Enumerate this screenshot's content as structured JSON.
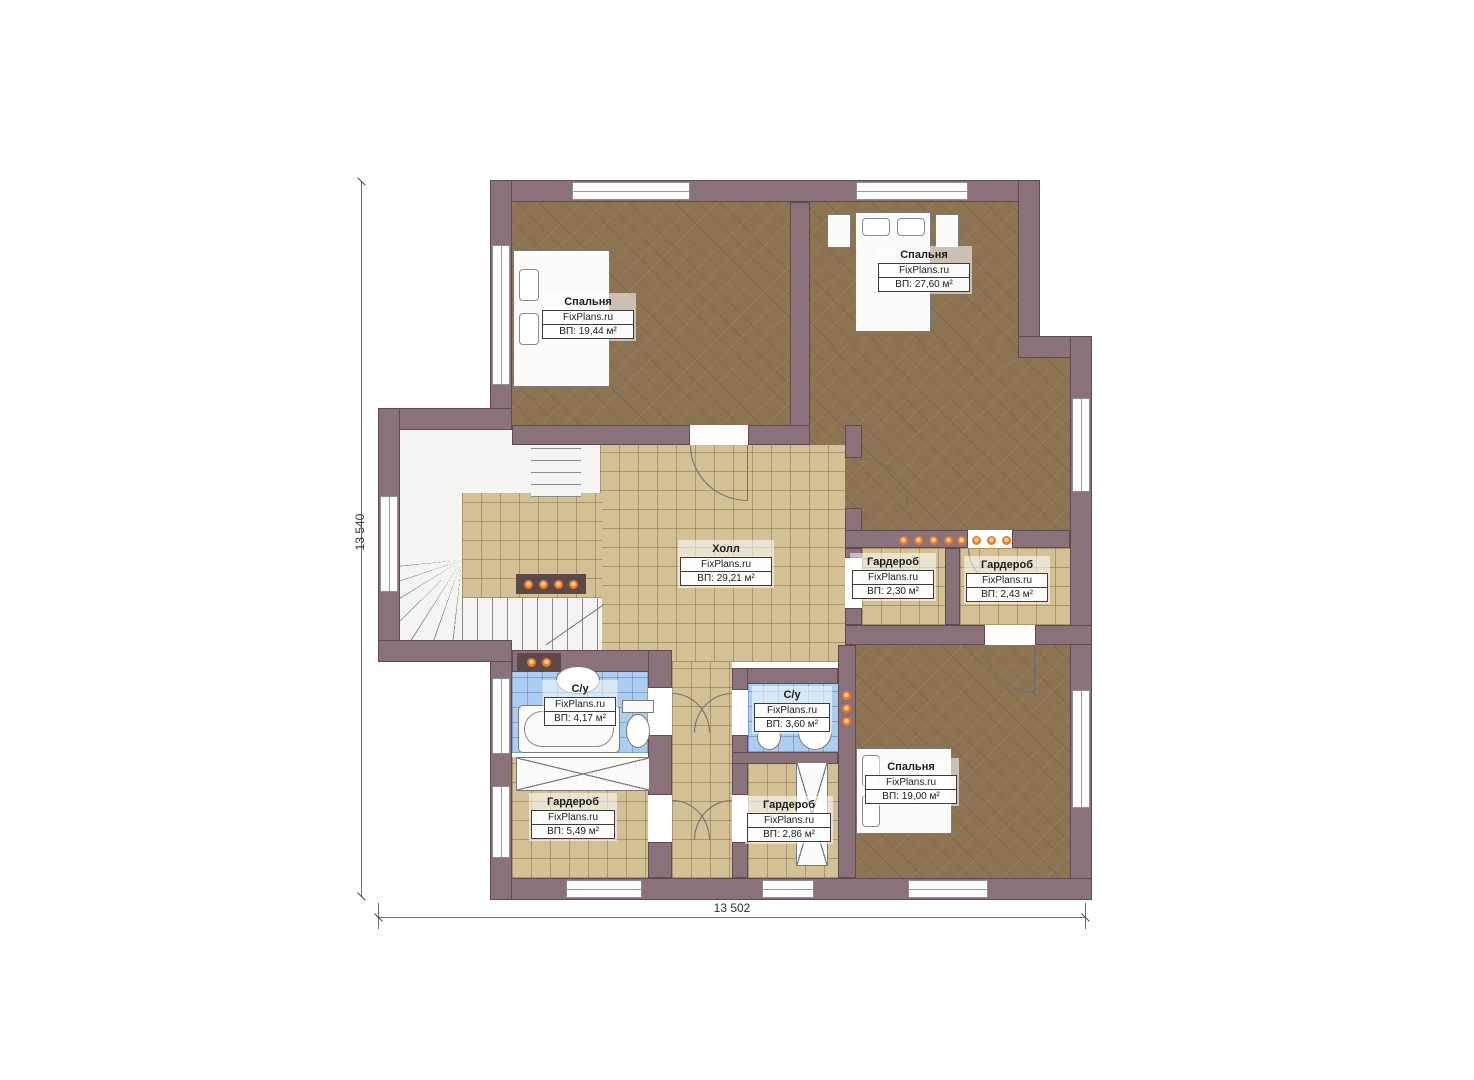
{
  "plan": {
    "type": "floor-plan",
    "watermark": "FixPlans.ru",
    "dimensions": {
      "left": "13 540",
      "bottom": "13 502"
    },
    "rooms": [
      {
        "name": "Спальня",
        "site": "FixPlans.ru",
        "area": "ВП: 19,44 м²"
      },
      {
        "name": "Спальня",
        "site": "FixPlans.ru",
        "area": "ВП: 27,60 м²"
      },
      {
        "name": "Холл",
        "site": "FixPlans.ru",
        "area": "ВП: 29,21 м²"
      },
      {
        "name": "Гардероб",
        "site": "FixPlans.ru",
        "area": "ВП: 2,30 м²"
      },
      {
        "name": "Гардероб",
        "site": "FixPlans.ru",
        "area": "ВП: 2,43 м²"
      },
      {
        "name": "С/у",
        "site": "FixPlans.ru",
        "area": "ВП: 4,17 м²"
      },
      {
        "name": "С/у",
        "site": "FixPlans.ru",
        "area": "ВП: 3,60 м²"
      },
      {
        "name": "Спальня",
        "site": "FixPlans.ru",
        "area": "ВП: 19,00 м²"
      },
      {
        "name": "Гардероб",
        "site": "FixPlans.ru",
        "area": "ВП: 5,49 м²"
      },
      {
        "name": "Гардероб",
        "site": "FixPlans.ru",
        "area": "ВП: 2,86 м²"
      }
    ],
    "symbols": [
      "bed-symbol",
      "bathtub-symbol",
      "toilet-symbol",
      "sink-symbol",
      "stairs-symbol",
      "radiator-dots",
      "wardrobe-crossed-box",
      "door-arc",
      "window"
    ],
    "colors": {
      "wall": "#8a717a",
      "wall_outline": "#5e474e",
      "wood_floor": "#8c7452",
      "tile_floor": "#d3c094",
      "bath_floor": "#aacdf0",
      "radiator_dot": "#f07a1e",
      "background": "#ffffff"
    }
  }
}
